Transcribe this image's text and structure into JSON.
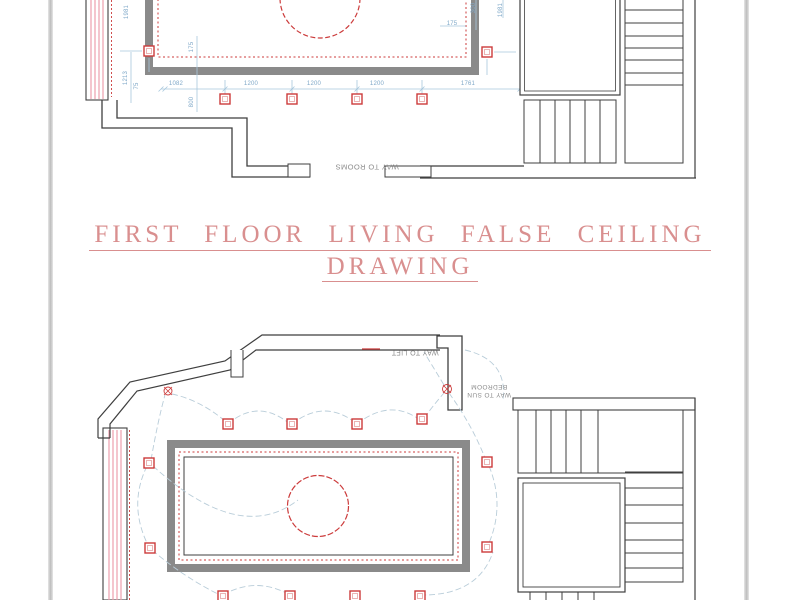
{
  "sheet": {
    "background": "#ffffff",
    "edge_color": "#c9c9c9"
  },
  "title": {
    "line1": "FIRST FLOOR LIVING FALSE CEILING",
    "line2": "DRAWING",
    "color": "#d98f8f"
  },
  "palette": {
    "wall_black": "#3f3f3f",
    "cove_gray": "#8a8a8a",
    "fixture_red": "#cc3b3b",
    "window_hatch_pink": "#ec9fae",
    "dimension_blue": "#a9c8dd",
    "dimension_text_blue": "#7fa8c8",
    "wiring_arc_blue": "#b9cdd9",
    "label_gray": "#8c8c8c"
  },
  "top_plan": {
    "way_to_rooms_label": "WAY TO ROOMS",
    "lights": [
      [
        149,
        51
      ],
      [
        487,
        52
      ],
      [
        225,
        99
      ],
      [
        292,
        99
      ],
      [
        357,
        99
      ],
      [
        422,
        99
      ]
    ],
    "dimensions": [
      {
        "text": "1981",
        "x": 127,
        "y": 12,
        "rot": -90
      },
      {
        "text": "1213",
        "x": 126,
        "y": 78,
        "rot": -90
      },
      {
        "text": "75",
        "x": 137,
        "y": 86,
        "rot": -90
      },
      {
        "text": "175",
        "x": 192,
        "y": 47,
        "rot": -90
      },
      {
        "text": "800",
        "x": 192,
        "y": 102,
        "rot": -90
      },
      {
        "text": "1082",
        "x": 176,
        "y": 84,
        "rot": 0
      },
      {
        "text": "1200",
        "x": 251,
        "y": 84,
        "rot": 0
      },
      {
        "text": "1200",
        "x": 314,
        "y": 84,
        "rot": 0
      },
      {
        "text": "1200",
        "x": 377,
        "y": 84,
        "rot": 0
      },
      {
        "text": "1761",
        "x": 468,
        "y": 84,
        "rot": 0
      },
      {
        "text": "175",
        "x": 452,
        "y": 24,
        "rot": 0
      },
      {
        "text": "300",
        "x": 474,
        "y": 8,
        "rot": -90
      },
      {
        "text": "1981",
        "x": 501,
        "y": 10,
        "rot": -90
      }
    ]
  },
  "bottom_plan": {
    "way_to_lift_label": "WAY TO LIFT",
    "way_to_sun_bedroom_line1": "WAY TO SUN",
    "way_to_sun_bedroom_line2": "BEDROOM",
    "lights": [
      [
        228,
        424
      ],
      [
        292,
        424
      ],
      [
        357,
        424
      ],
      [
        422,
        419
      ],
      [
        149,
        463
      ],
      [
        150,
        548
      ],
      [
        487,
        462
      ],
      [
        487,
        547
      ],
      [
        223,
        596
      ],
      [
        290,
        596
      ],
      [
        355,
        596
      ],
      [
        420,
        596
      ]
    ]
  }
}
